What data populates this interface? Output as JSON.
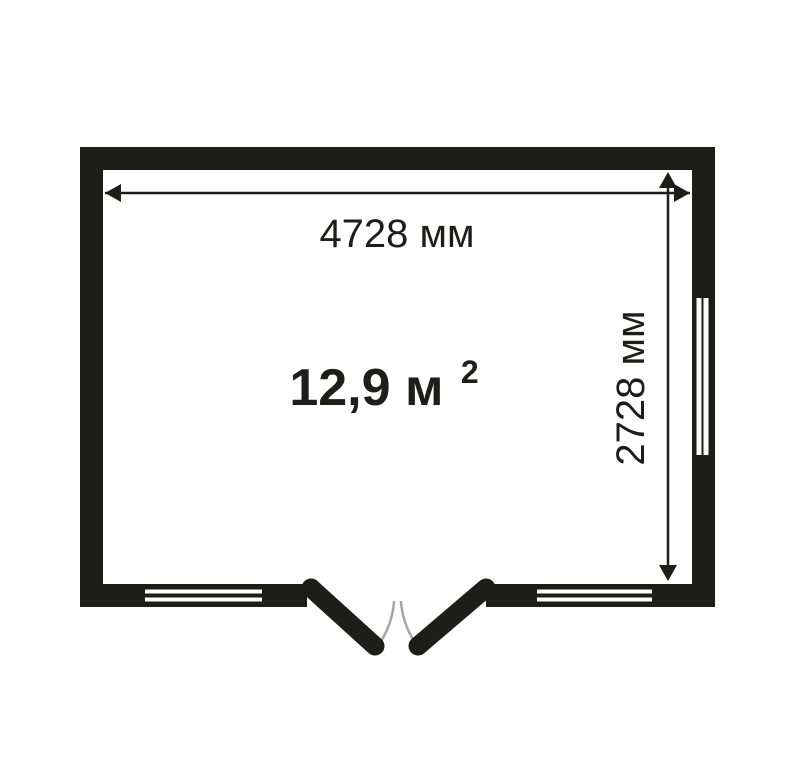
{
  "floor_plan": {
    "dimensions": {
      "width_label": "4728 мм",
      "height_label": "2728 мм"
    },
    "area": {
      "value": "12,9 м",
      "exponent": "2"
    },
    "colors": {
      "wall": "#1d1d1b",
      "dimension": "#1d1d1b",
      "text": "#1d1d1b",
      "door_swing_arc": "#a6a6a6",
      "background": "#ffffff"
    }
  }
}
